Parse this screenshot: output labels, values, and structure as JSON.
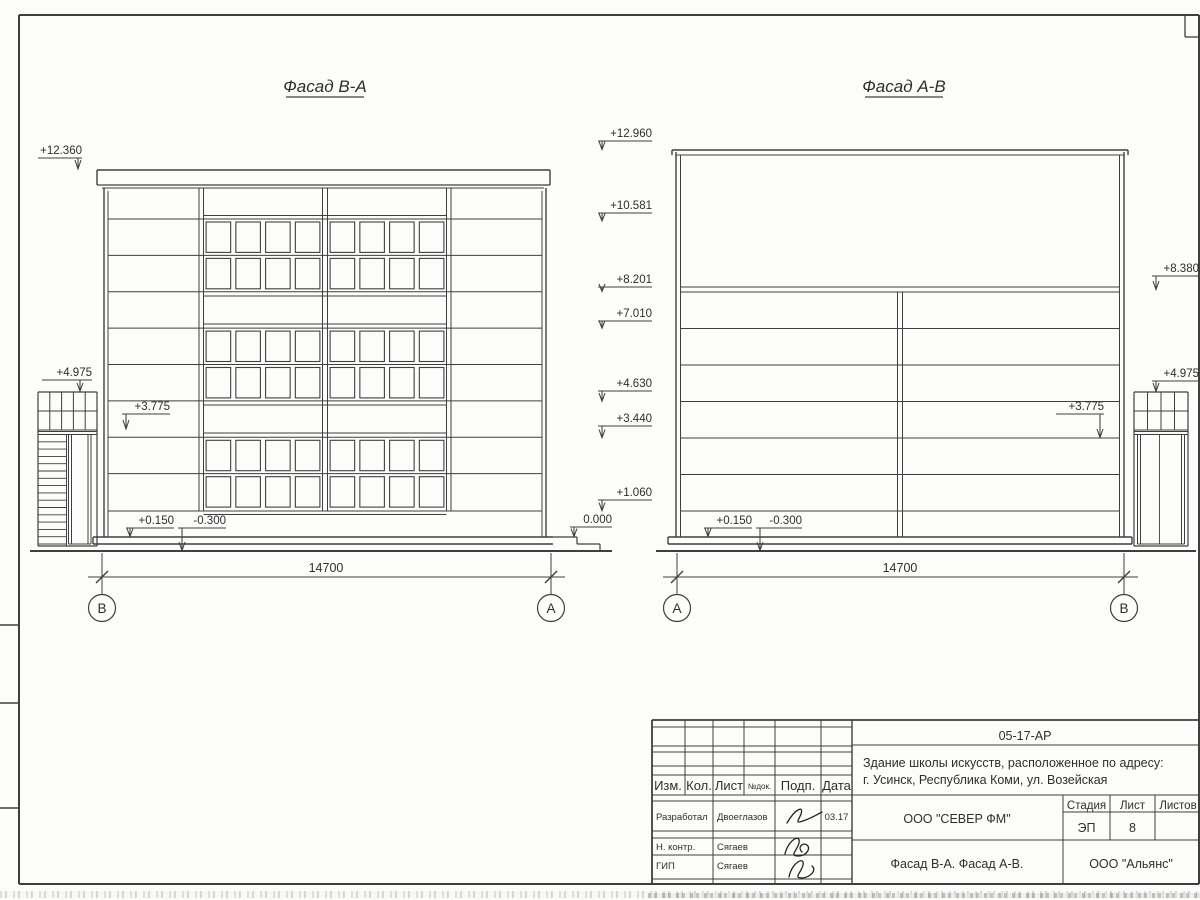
{
  "colors": {
    "ink": "#3f3f3f",
    "paper": "#fcfcfa"
  },
  "facade_left": {
    "title": "Фасад В-А",
    "dimension": "14700",
    "axis_left": "В",
    "axis_right": "А",
    "levels": {
      "roof": "+12.360",
      "stair_top": "+4.975",
      "mid": "+3.775",
      "plinth": "+0.150",
      "ground": "-0.300",
      "entrance": "0.000"
    }
  },
  "mid_levels": [
    "+12.960",
    "+10.581",
    "+8.201",
    "+7.010",
    "+4.630",
    "+3.440",
    "+1.060"
  ],
  "facade_right": {
    "title": "Фасад А-В",
    "dimension": "14700",
    "axis_left": "А",
    "axis_right": "В",
    "levels": {
      "canopy": "+8.380",
      "stair_top": "+4.975",
      "mid": "+3.775",
      "plinth": "+0.150",
      "ground": "-0.300"
    }
  },
  "title_block": {
    "doc_number": "05-17-АР",
    "object_line1": "Здание школы искусств, расположенное по адресу:",
    "object_line2": "г. Усинск, Республика Коми, ул. Возейская",
    "columns": {
      "izm": "Изм.",
      "kol": "Кол.",
      "list": "Лист",
      "ndok": "№док.",
      "podp": "Подп.",
      "data": "Дата"
    },
    "stage_label": "Стадия",
    "sheet_label": "Лист",
    "sheets_label": "Листов",
    "stage": "ЭП",
    "sheet_no": "8",
    "org1": "ООО \"СЕВЕР ФМ\"",
    "org2": "ООО \"Альянс\"",
    "sheet_title": "Фасад В-А. Фасад А-В.",
    "roles": [
      {
        "role": "Разработал",
        "name": "Двоеглазов",
        "date": "03.17"
      },
      {
        "role": "Н. контр.",
        "name": "Сягаев",
        "date": ""
      },
      {
        "role": "ГИП",
        "name": "Сягаев",
        "date": ""
      }
    ]
  }
}
